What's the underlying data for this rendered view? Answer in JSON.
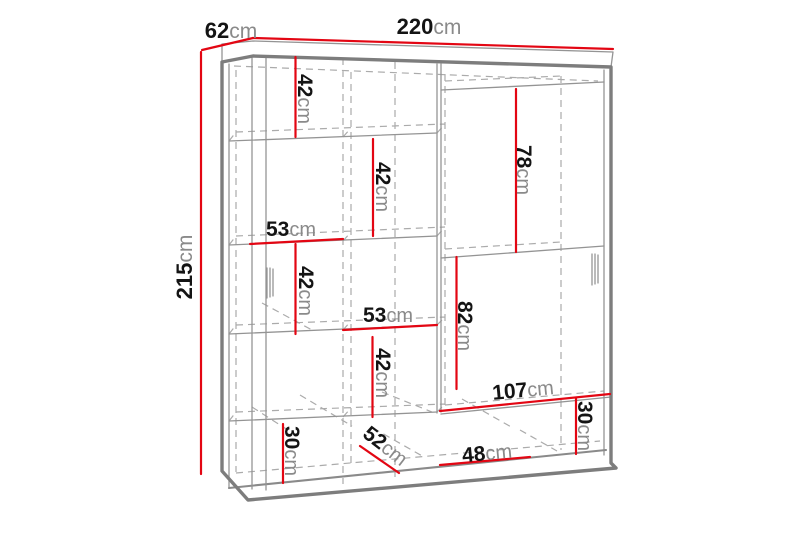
{
  "diagram": {
    "type": "furniture-dimension-drawing",
    "subject": "sliding-door wardrobe with internal shelves",
    "unit": "cm",
    "colors": {
      "dimension_line": "#e30613",
      "structure_line": "#8c8c8c",
      "hidden_line": "#ababab",
      "label_number": "#141414",
      "label_unit": "#8a8a8a",
      "background": "#ffffff"
    }
  },
  "dims": {
    "width": {
      "num": "220",
      "unit": "cm"
    },
    "depth": {
      "num": "62",
      "unit": "cm"
    },
    "height": {
      "num": "215",
      "unit": "cm"
    },
    "shelf_h_1": {
      "num": "42",
      "unit": "cm"
    },
    "shelf_h_2": {
      "num": "42",
      "unit": "cm"
    },
    "shelf_w_1": {
      "num": "53",
      "unit": "cm"
    },
    "shelf_h_3": {
      "num": "42",
      "unit": "cm"
    },
    "shelf_w_2": {
      "num": "53",
      "unit": "cm"
    },
    "shelf_h_4": {
      "num": "42",
      "unit": "cm"
    },
    "right_top_h": {
      "num": "78",
      "unit": "cm"
    },
    "right_mid_h": {
      "num": "82",
      "unit": "cm"
    },
    "bottom_w_right": {
      "num": "107",
      "unit": "cm"
    },
    "bottom_h_left": {
      "num": "30",
      "unit": "cm"
    },
    "interior_depth": {
      "num": "52",
      "unit": "cm"
    },
    "bottom_w_mid": {
      "num": "48",
      "unit": "cm"
    },
    "bottom_h_right": {
      "num": "30",
      "unit": "cm"
    }
  }
}
